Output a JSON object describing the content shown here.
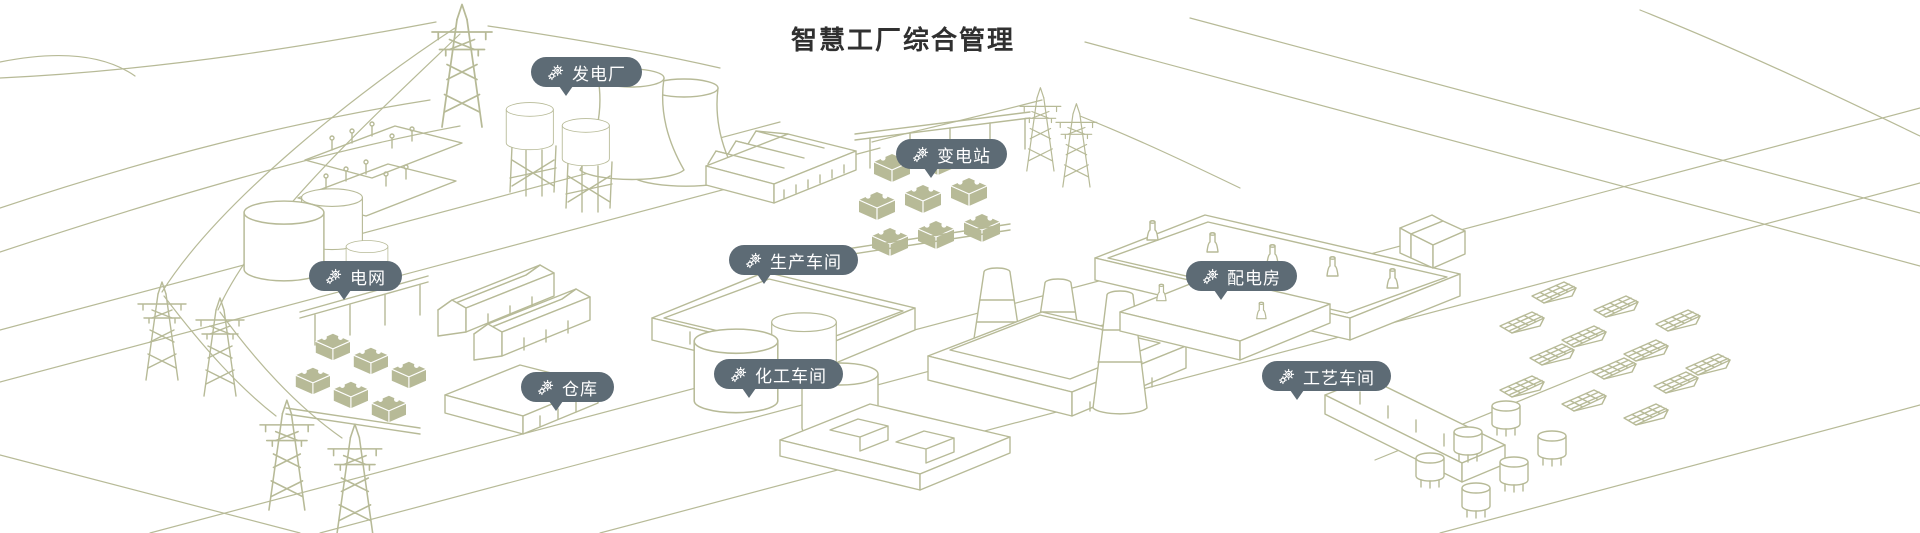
{
  "page": {
    "title": "智慧工厂综合管理"
  },
  "colors": {
    "badge_bg": "#5d6b75",
    "badge_text": "#ffffff",
    "line_art": "#b7ba97",
    "title_color": "#303030",
    "background": "#ffffff"
  },
  "markers": [
    {
      "id": "power-plant",
      "label": "发电厂",
      "icon": "gears-icon",
      "x": 531,
      "y": 57
    },
    {
      "id": "substation",
      "label": "变电站",
      "icon": "gears-icon",
      "x": 896,
      "y": 139
    },
    {
      "id": "power-grid",
      "label": "电网",
      "icon": "gears-icon",
      "x": 309,
      "y": 261
    },
    {
      "id": "production-workshop",
      "label": "生产车间",
      "icon": "gears-icon",
      "x": 729,
      "y": 245
    },
    {
      "id": "distribution-room",
      "label": "配电房",
      "icon": "gears-icon",
      "x": 1186,
      "y": 261
    },
    {
      "id": "warehouse",
      "label": "仓库",
      "icon": "gears-icon",
      "x": 521,
      "y": 372
    },
    {
      "id": "chemical-workshop",
      "label": "化工车间",
      "icon": "gears-icon",
      "x": 714,
      "y": 359
    },
    {
      "id": "process-workshop",
      "label": "工艺车间",
      "icon": "gears-icon",
      "x": 1262,
      "y": 361
    }
  ]
}
